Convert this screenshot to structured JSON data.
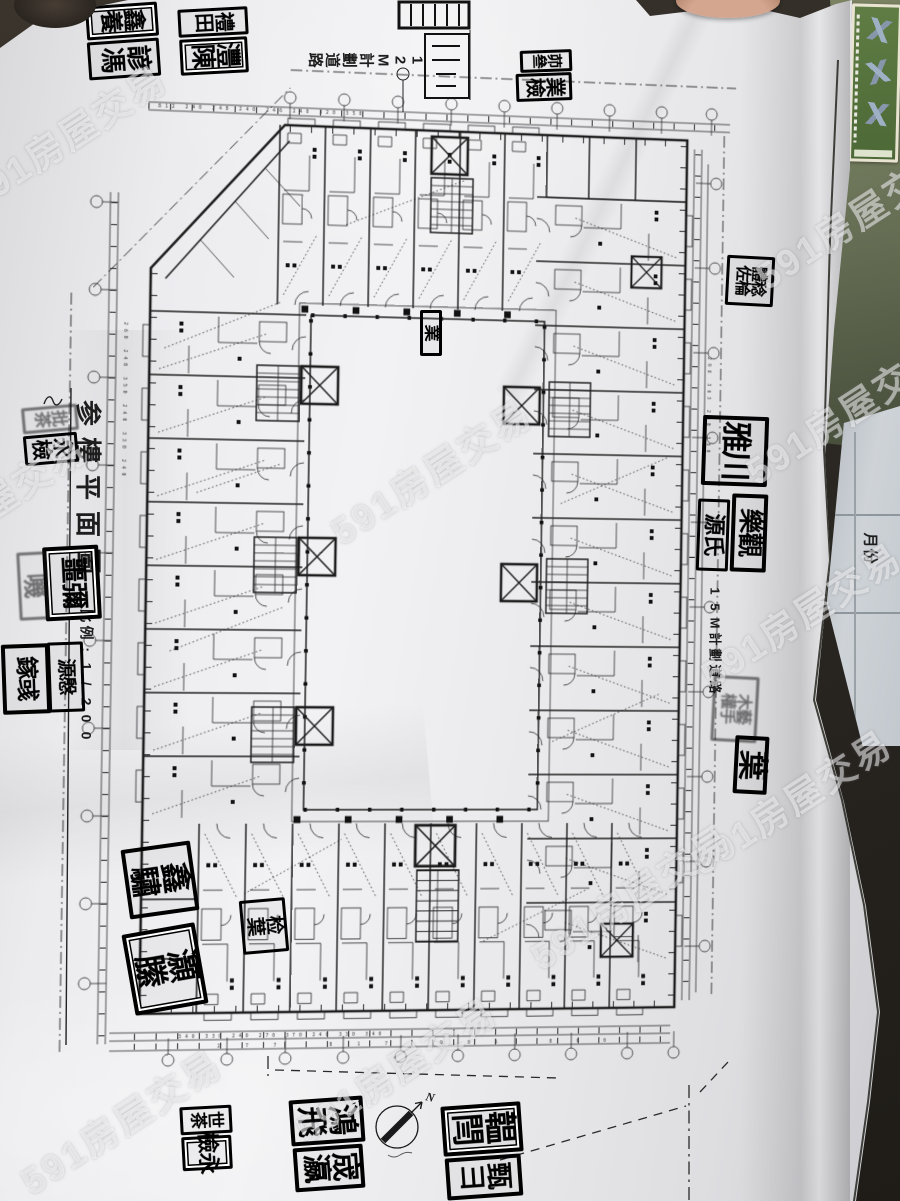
{
  "photo_meta": {
    "watermark": "591房屋交易"
  },
  "drawing": {
    "title": "参樓平面圖",
    "scale": "比例:1/200",
    "road_label_top": "12M計劃道路",
    "road_label_right": "15M計劃道路",
    "compass_north": "N",
    "dims": {
      "top": "812 240 248 240 246 240 320 350",
      "bottom_a": "340 330 240 270 370 240 330 340",
      "bottom_b": "277 817 905 860",
      "left": "260 240 350 240 330 240",
      "right": "298 363 240 350"
    }
  },
  "under_sheet": {
    "label": "月份"
  },
  "stamps": [
    {
      "x": 122,
      "y": 21,
      "w": 72,
      "h": 34,
      "r": -4,
      "t": "養鑫",
      "f": 23,
      "c": "d"
    },
    {
      "x": 124,
      "y": 59,
      "w": 72,
      "h": 38,
      "r": -4,
      "t": "馮諺",
      "f": 26,
      "c": ""
    },
    {
      "x": 213,
      "y": 22,
      "w": 70,
      "h": 28,
      "r": -3,
      "t": "田禮",
      "f": 20,
      "c": ""
    },
    {
      "x": 214,
      "y": 56,
      "w": 68,
      "h": 36,
      "r": -3,
      "t": "陳灃",
      "f": 25,
      "c": "d"
    },
    {
      "x": 546,
      "y": 61,
      "w": 52,
      "h": 22,
      "r": -2,
      "t": "叄茆",
      "f": 15,
      "c": ""
    },
    {
      "x": 544,
      "y": 87,
      "w": 56,
      "h": 28,
      "r": -2,
      "t": "檢業",
      "f": 20,
      "c": ""
    },
    {
      "x": 431,
      "y": 333,
      "w": 22,
      "h": 46,
      "r": 0,
      "t": "業",
      "f": 17,
      "c": ""
    },
    {
      "x": 750,
      "y": 281,
      "w": 48,
      "h": 50,
      "r": 3,
      "t": "佐體棆稔",
      "f": 16,
      "c": ""
    },
    {
      "x": 735,
      "y": 451,
      "w": 66,
      "h": 70,
      "r": 2,
      "t": "雅川",
      "f": 31,
      "c": "b"
    },
    {
      "x": 713,
      "y": 535,
      "w": 32,
      "h": 72,
      "r": 2,
      "t": "源氏",
      "f": 22,
      "c": ""
    },
    {
      "x": 749,
      "y": 533,
      "w": 36,
      "h": 78,
      "r": 2,
      "t": "樂觀",
      "f": 25,
      "c": "b"
    },
    {
      "x": 735,
      "y": 709,
      "w": 46,
      "h": 66,
      "r": 3,
      "t": "權木手藝",
      "f": 16,
      "c": "l"
    },
    {
      "x": 751,
      "y": 765,
      "w": 34,
      "h": 58,
      "r": 3,
      "t": "葉",
      "f": 30,
      "c": "b"
    },
    {
      "x": 50,
      "y": 419,
      "w": 56,
      "h": 26,
      "r": -5,
      "t": "茶批",
      "f": 17,
      "c": "l"
    },
    {
      "x": 51,
      "y": 449,
      "w": 54,
      "h": 30,
      "r": -5,
      "t": "檢永",
      "f": 21,
      "c": ""
    },
    {
      "x": 72,
      "y": 583,
      "w": 56,
      "h": 74,
      "r": -3,
      "t": "噩彌",
      "f": 27,
      "c": "b d"
    },
    {
      "x": 33,
      "y": 586,
      "w": 30,
      "h": 68,
      "r": -3,
      "t": "嘰",
      "f": 25,
      "c": "l"
    },
    {
      "x": 26,
      "y": 679,
      "w": 48,
      "h": 70,
      "r": -2,
      "t": "鎵彧",
      "f": 23,
      "c": "b"
    },
    {
      "x": 66,
      "y": 677,
      "w": 36,
      "h": 70,
      "r": -2,
      "t": "源慇",
      "f": 19,
      "c": ""
    },
    {
      "x": 160,
      "y": 880,
      "w": 70,
      "h": 70,
      "r": -8,
      "t": "驌鑫",
      "f": 31,
      "c": "b"
    },
    {
      "x": 165,
      "y": 969,
      "w": 74,
      "h": 82,
      "r": -10,
      "t": "縢灝",
      "f": 33,
      "c": "b d"
    },
    {
      "x": 264,
      "y": 926,
      "w": 46,
      "h": 54,
      "r": -5,
      "t": "葉检",
      "f": 19,
      "c": ""
    },
    {
      "x": 206,
      "y": 1120,
      "w": 52,
      "h": 28,
      "r": -3,
      "t": "茶世",
      "f": 17,
      "c": ""
    },
    {
      "x": 207,
      "y": 1153,
      "w": 50,
      "h": 34,
      "r": -3,
      "t": "檢永",
      "f": 22,
      "c": "d"
    },
    {
      "x": 327,
      "y": 1121,
      "w": 74,
      "h": 46,
      "r": -4,
      "t": "飛鴻",
      "f": 31,
      "c": "b"
    },
    {
      "x": 329,
      "y": 1168,
      "w": 70,
      "h": 44,
      "r": -4,
      "t": "瀛宬",
      "f": 29,
      "c": "b"
    },
    {
      "x": 482,
      "y": 1129,
      "w": 80,
      "h": 50,
      "r": -4,
      "t": "閆韞",
      "f": 33,
      "c": "b d"
    },
    {
      "x": 484,
      "y": 1177,
      "w": 76,
      "h": 42,
      "r": -4,
      "t": "彐甄",
      "f": 27,
      "c": "b"
    }
  ],
  "watermarks": [
    {
      "x": 65,
      "y": 135
    },
    {
      "x": 855,
      "y": 215
    },
    {
      "x": 430,
      "y": 470
    },
    {
      "x": -15,
      "y": 505
    },
    {
      "x": 845,
      "y": 410
    },
    {
      "x": 800,
      "y": 613
    },
    {
      "x": 790,
      "y": 800
    },
    {
      "x": 630,
      "y": 895
    },
    {
      "x": 395,
      "y": 1068
    },
    {
      "x": 120,
      "y": 1120
    }
  ]
}
